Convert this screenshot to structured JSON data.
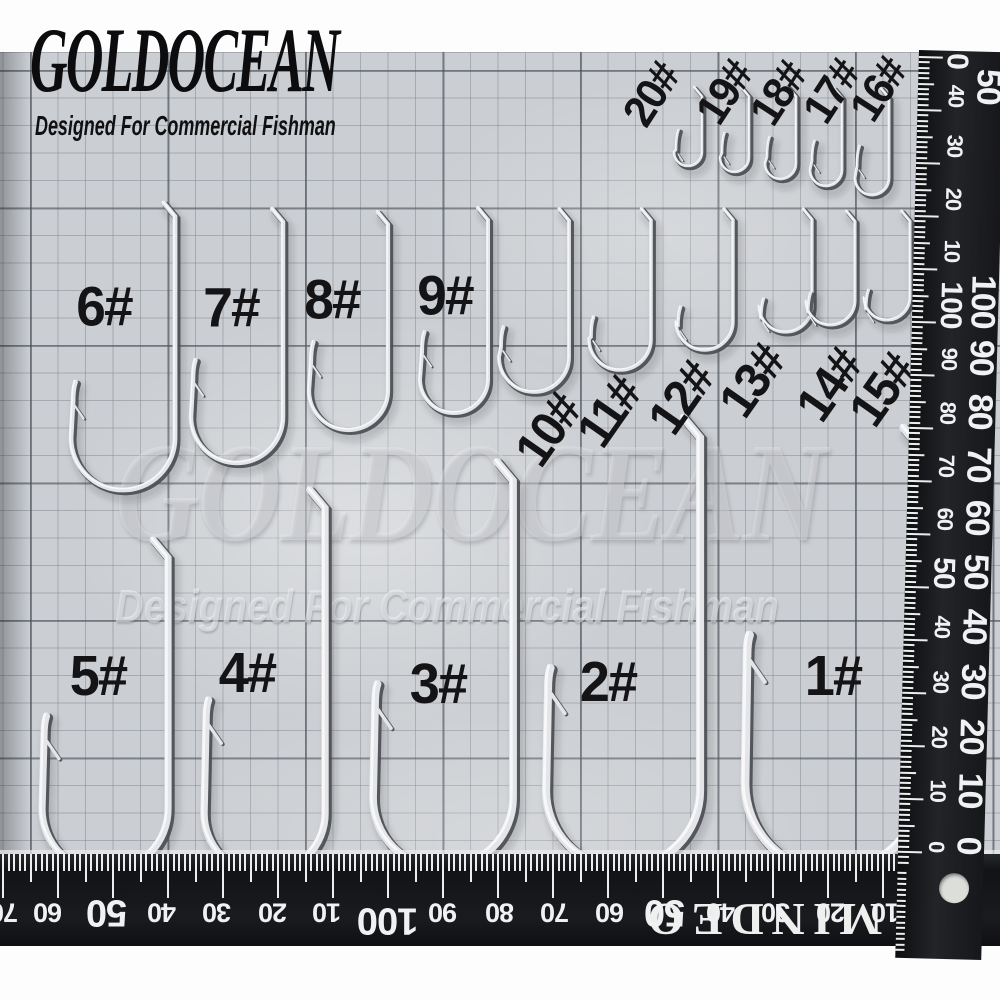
{
  "image_type": "fishing-hook-size-chart-photo",
  "brand": {
    "name": "GOLDOCEAN",
    "tagline": "Designed For Commercial Fishman"
  },
  "watermark": {
    "line1": "GOLDOCEAN",
    "line2": "Designed For Commercial Fishman"
  },
  "hooks": [
    {
      "label": "20#",
      "lx": 652,
      "ly": 95,
      "rot": -57,
      "ls": 44,
      "x": 702,
      "t": 87,
      "b": 166,
      "g": 28,
      "tip": 130,
      "w": 2.6
    },
    {
      "label": "19#",
      "lx": 725,
      "ly": 93,
      "rot": -57,
      "ls": 44,
      "x": 749,
      "t": 87,
      "b": 172,
      "g": 29,
      "tip": 133,
      "w": 2.6
    },
    {
      "label": "18#",
      "lx": 779,
      "ly": 94,
      "rot": -57,
      "ls": 44,
      "x": 796,
      "t": 87,
      "b": 179,
      "g": 31,
      "tip": 137,
      "w": 2.7
    },
    {
      "label": "17#",
      "lx": 832,
      "ly": 92,
      "rot": -57,
      "ls": 44,
      "x": 842,
      "t": 88,
      "b": 186,
      "g": 32,
      "tip": 141,
      "w": 2.8
    },
    {
      "label": "16#",
      "lx": 879,
      "ly": 90,
      "rot": -57,
      "ls": 44,
      "x": 889,
      "t": 88,
      "b": 195,
      "g": 34,
      "tip": 146,
      "w": 2.9
    },
    {
      "label": "6#",
      "lx": 104,
      "ly": 306,
      "rot": 0,
      "ls": 56,
      "x": 175,
      "t": 203,
      "b": 490,
      "g": 104,
      "tip": 382,
      "w": 4.8
    },
    {
      "label": "7#",
      "lx": 231,
      "ly": 307,
      "rot": 0,
      "ls": 56,
      "x": 283,
      "t": 209,
      "b": 463,
      "g": 92,
      "tip": 360,
      "w": 4.5
    },
    {
      "label": "8#",
      "lx": 332,
      "ly": 299,
      "rot": 0,
      "ls": 56,
      "x": 388,
      "t": 212,
      "b": 430,
      "g": 79,
      "tip": 342,
      "w": 4.2
    },
    {
      "label": "9#",
      "lx": 445,
      "ly": 295,
      "rot": 0,
      "ls": 56,
      "x": 488,
      "t": 208,
      "b": 413,
      "g": 68,
      "tip": 332,
      "w": 4.0
    },
    {
      "label": "10#",
      "lx": 548,
      "ly": 430,
      "rot": -55,
      "ls": 50,
      "x": 569,
      "t": 209,
      "b": 392,
      "g": 70,
      "tip": 327,
      "w": 3.8
    },
    {
      "label": "11#",
      "lx": 609,
      "ly": 412,
      "rot": -55,
      "ls": 50,
      "x": 651,
      "t": 209,
      "b": 370,
      "g": 62,
      "tip": 317,
      "w": 3.6
    },
    {
      "label": "12#",
      "lx": 681,
      "ly": 398,
      "rot": -55,
      "ls": 50,
      "x": 733,
      "t": 209,
      "b": 350,
      "g": 57,
      "tip": 307,
      "w": 3.4
    },
    {
      "label": "13#",
      "lx": 752,
      "ly": 381,
      "rot": -55,
      "ls": 50,
      "x": 812,
      "t": 209,
      "b": 332,
      "g": 53,
      "tip": 299,
      "w": 3.2
    },
    {
      "label": "14#",
      "lx": 829,
      "ly": 385,
      "rot": -55,
      "ls": 50,
      "x": 855,
      "t": 211,
      "b": 325,
      "g": 49,
      "tip": 293,
      "w": 3.1
    },
    {
      "label": "15#",
      "lx": 882,
      "ly": 390,
      "rot": -55,
      "ls": 50,
      "x": 910,
      "t": 211,
      "b": 320,
      "g": 46,
      "tip": 290,
      "w": 3.0
    },
    {
      "label": "5#",
      "lx": 98,
      "ly": 676,
      "rot": 0,
      "ls": 57,
      "x": 168,
      "t": 540,
      "b": 872,
      "g": 126,
      "tip": 716,
      "w": 7.2
    },
    {
      "label": "4#",
      "lx": 247,
      "ly": 673,
      "rot": 0,
      "ls": 57,
      "x": 325,
      "t": 490,
      "b": 874,
      "g": 121,
      "tip": 700,
      "w": 7.4
    },
    {
      "label": "3#",
      "lx": 438,
      "ly": 684,
      "rot": 0,
      "ls": 57,
      "x": 513,
      "t": 462,
      "b": 868,
      "g": 140,
      "tip": 684,
      "w": 7.8
    },
    {
      "label": "2#",
      "lx": 608,
      "ly": 682,
      "rot": 0,
      "ls": 57,
      "x": 700,
      "t": 418,
      "b": 868,
      "g": 154,
      "tip": 668,
      "w": 8.2
    },
    {
      "label": "1#",
      "lx": 833,
      "ly": 676,
      "rot": 0,
      "ls": 57,
      "x": 921,
      "t": 428,
      "b": 872,
      "g": 176,
      "tip": 635,
      "w": 8.8
    }
  ],
  "right_ruler": {
    "numbers": [
      {
        "v": "0",
        "d": 10,
        "big": 1
      },
      {
        "v": "40",
        "d": 45
      },
      {
        "v": "30",
        "d": 95
      },
      {
        "v": "20",
        "d": 148
      },
      {
        "v": "10",
        "d": 200
      },
      {
        "v": "100",
        "d": 254,
        "big": 1
      },
      {
        "v": "90",
        "d": 308
      },
      {
        "v": "80",
        "d": 362
      },
      {
        "v": "70",
        "d": 415
      },
      {
        "v": "60",
        "d": 468
      },
      {
        "v": "50",
        "d": 522,
        "big": 1
      },
      {
        "v": "40",
        "d": 576
      },
      {
        "v": "30",
        "d": 631
      },
      {
        "v": "20",
        "d": 686
      },
      {
        "v": "10",
        "d": 740
      },
      {
        "v": "0",
        "d": 796
      }
    ],
    "edge_numbers": [
      {
        "v": "50",
        "d": 35
      },
      {
        "v": "100",
        "d": 250
      },
      {
        "v": "90",
        "d": 306
      },
      {
        "v": "80",
        "d": 360
      },
      {
        "v": "70",
        "d": 413
      },
      {
        "v": "60",
        "d": 466
      },
      {
        "v": "50",
        "d": 520
      },
      {
        "v": "40",
        "d": 575
      },
      {
        "v": "30",
        "d": 630
      },
      {
        "v": "20",
        "d": 685
      },
      {
        "v": "10",
        "d": 739
      },
      {
        "v": "0",
        "d": 794
      }
    ]
  },
  "bottom_ruler": {
    "numbers": [
      {
        "v": "70",
        "x": 4
      },
      {
        "v": "60",
        "x": 48
      },
      {
        "v": "50",
        "x": 107,
        "big": 1
      },
      {
        "v": "40",
        "x": 162
      },
      {
        "v": "30",
        "x": 217
      },
      {
        "v": "20",
        "x": 273
      },
      {
        "v": "10",
        "x": 327
      },
      {
        "v": "100",
        "x": 388,
        "big": 1,
        "dy": 8
      },
      {
        "v": "90",
        "x": 443
      },
      {
        "v": "80",
        "x": 500
      },
      {
        "v": "70",
        "x": 555
      },
      {
        "v": "60",
        "x": 610
      },
      {
        "v": "50",
        "x": 665,
        "big": 1
      },
      {
        "v": "40",
        "x": 721
      },
      {
        "v": "30",
        "x": 776
      },
      {
        "v": "20",
        "x": 831
      },
      {
        "v": "10",
        "x": 886
      },
      {
        "v": "0",
        "x": 953
      }
    ],
    "edge_text": "MINDEO"
  },
  "colors": {
    "mat": "#cbced2",
    "ruler_black": "#17181b",
    "label_ink": "#141416",
    "wire_light": "#e3e5e8",
    "wire_dark": "#4b4f55",
    "tick_white": "#eceeee"
  }
}
